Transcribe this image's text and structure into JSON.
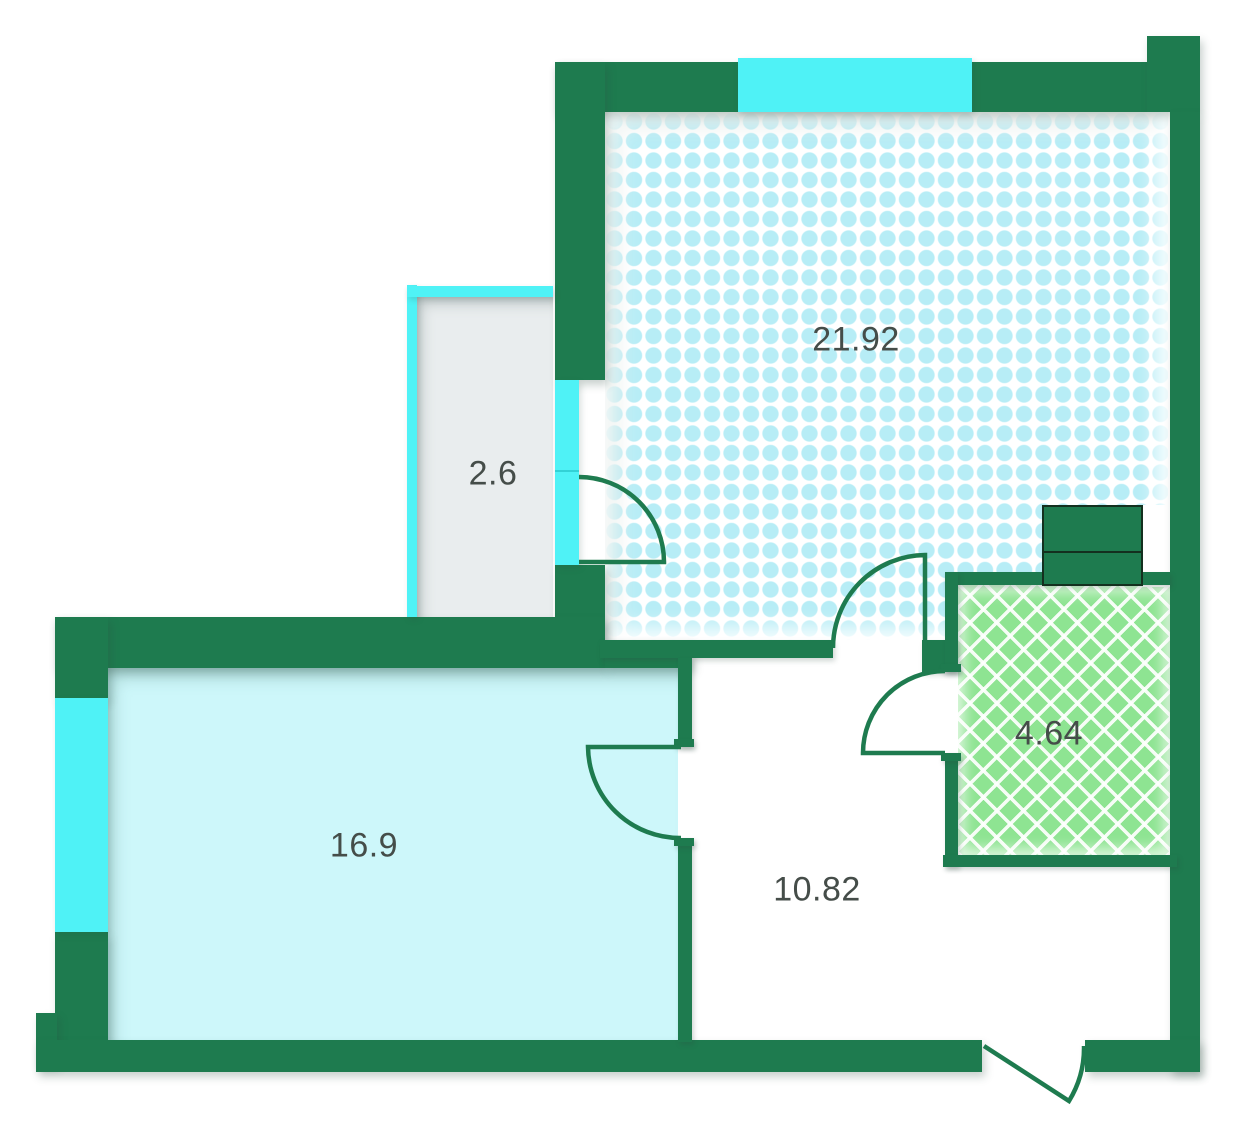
{
  "plan": {
    "type": "apartment-floor-plan",
    "rooms": [
      {
        "name": "living-room",
        "area": "21.92",
        "fill_pattern": "cyan-dot-grid"
      },
      {
        "name": "balcony",
        "area": "2.6",
        "fill_pattern": "plain-gray"
      },
      {
        "name": "bedroom",
        "area": "16.9",
        "fill_pattern": "plain-cyan"
      },
      {
        "name": "hallway",
        "area": "10.82",
        "fill_pattern": "plain-white"
      },
      {
        "name": "bathroom",
        "area": "4.64",
        "fill_pattern": "green-crosshatch"
      }
    ],
    "colors": {
      "wall": "#1e7b4f",
      "window_glass": "#4ff2f6",
      "living_room_fill": "#b7edf6",
      "bedroom_fill": "#cdf7fa",
      "balcony_fill": "#e9edee",
      "bathroom_fill": "#8ee492",
      "label_text": "#454d49"
    }
  }
}
